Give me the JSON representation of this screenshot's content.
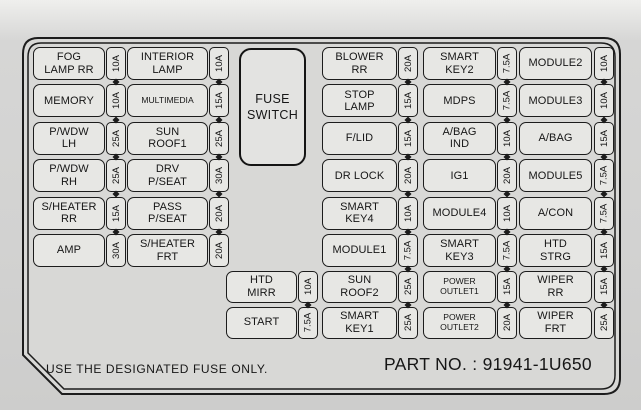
{
  "diagram": {
    "fuse_switch_label": "FUSE\nSWITCH",
    "footer_note": "USE THE DESIGNATED FUSE ONLY.",
    "part_no": "PART NO. : 91941-1U650",
    "colors": {
      "line": "#1c1c1c",
      "box_fill": "#e7e7e4",
      "panel_fill": "#d8d8d6",
      "page_bg": "#d2d2d1",
      "text": "#161616"
    }
  },
  "fuse_columns": [
    {
      "id": "left-1",
      "rows": [
        {
          "label": "FOG\nLAMP RR",
          "amp": "10A"
        },
        {
          "label": "MEMORY",
          "amp": "10A"
        },
        {
          "label": "P/WDW\nLH",
          "amp": "25A"
        },
        {
          "label": "P/WDW\nRH",
          "amp": "25A"
        },
        {
          "label": "S/HEATER\nRR",
          "amp": "15A"
        },
        {
          "label": "AMP",
          "amp": "30A"
        }
      ]
    },
    {
      "id": "left-2",
      "rows": [
        {
          "label": "INTERIOR\nLAMP",
          "amp": "10A"
        },
        {
          "label": "MULTIMEDIA",
          "amp": "15A",
          "small": true
        },
        {
          "label": "SUN\nROOF1",
          "amp": "25A"
        },
        {
          "label": "DRV\nP/SEAT",
          "amp": "30A"
        },
        {
          "label": "PASS\nP/SEAT",
          "amp": "20A"
        },
        {
          "label": "S/HEATER\nFRT",
          "amp": "20A"
        }
      ]
    },
    {
      "id": "right-1",
      "rows": [
        {
          "label": "BLOWER\nRR",
          "amp": "20A"
        },
        {
          "label": "STOP\nLAMP",
          "amp": "15A"
        },
        {
          "label": "F/LID",
          "amp": "15A"
        },
        {
          "label": "DR LOCK",
          "amp": "20A"
        },
        {
          "label": "SMART\nKEY4",
          "amp": "10A"
        },
        {
          "label": "MODULE1",
          "amp": "7.5A"
        }
      ]
    },
    {
      "id": "right-2",
      "rows": [
        {
          "label": "SMART\nKEY2",
          "amp": "7.5A"
        },
        {
          "label": "MDPS",
          "amp": "7.5A"
        },
        {
          "label": "A/BAG\nIND",
          "amp": "10A"
        },
        {
          "label": "IG1",
          "amp": "20A"
        },
        {
          "label": "MODULE4",
          "amp": "10A"
        },
        {
          "label": "SMART\nKEY3",
          "amp": "7.5A"
        }
      ]
    },
    {
      "id": "right-3",
      "rows": [
        {
          "label": "MODULE2",
          "amp": "10A"
        },
        {
          "label": "MODULE3",
          "amp": "10A"
        },
        {
          "label": "A/BAG",
          "amp": "15A"
        },
        {
          "label": "MODULE5",
          "amp": "7.5A"
        },
        {
          "label": "A/CON",
          "amp": "7.5A"
        },
        {
          "label": "HTD\nSTRG",
          "amp": "15A"
        }
      ]
    }
  ],
  "bottom_columns": [
    {
      "id": "bottom-0",
      "rows": [
        {
          "label": "HTD\nMIRR",
          "amp": "10A"
        },
        {
          "label": "START",
          "amp": "7.5A"
        }
      ]
    },
    {
      "id": "bottom-1",
      "rows": [
        {
          "label": "SUN\nROOF2",
          "amp": "25A"
        },
        {
          "label": "SMART\nKEY1",
          "amp": "25A"
        }
      ]
    },
    {
      "id": "bottom-2",
      "rows": [
        {
          "label": "POWER\nOUTLET1",
          "amp": "15A",
          "small": true
        },
        {
          "label": "POWER\nOUTLET2",
          "amp": "20A",
          "small": true
        }
      ]
    },
    {
      "id": "bottom-3",
      "rows": [
        {
          "label": "WIPER\nRR",
          "amp": "15A"
        },
        {
          "label": "WIPER\nFRT",
          "amp": "25A"
        }
      ]
    }
  ]
}
